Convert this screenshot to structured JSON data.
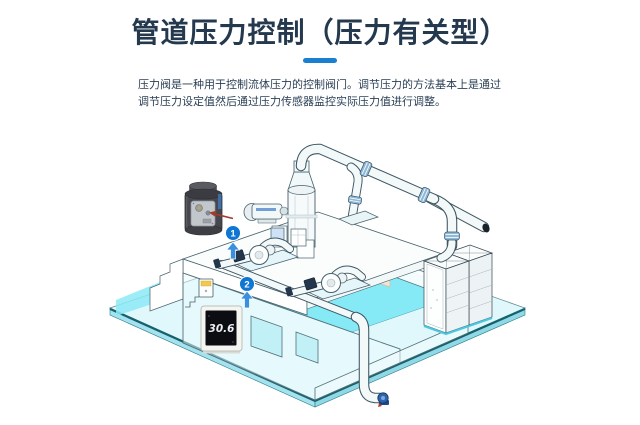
{
  "slide": {
    "title": "管道压力控制（压力有关型）",
    "description_line1": "压力阀是一种用于控制流体压力的控制阀门。调节压力的方法基本上是通过",
    "description_line2": "调节压力设定值然后通过压力传感器监控实际压力值进行调整。"
  },
  "diagram": {
    "step_markers": [
      {
        "label": "1"
      },
      {
        "label": "2"
      }
    ],
    "pressure_display_value": "30.6",
    "icons": {
      "step_arrow": "up-arrow",
      "valve_callout": "red-arrow"
    },
    "colors": {
      "title_text": "#24384e",
      "accent_bar": "#1a7fd1",
      "marker_blue": "#0f77d3",
      "arrow_blue": "#3a90de",
      "water_cyan": "#7de9f6",
      "floor_edge_teal": "#17606b",
      "callout_red": "#a23b2c",
      "valve_body_gray": "#47484e",
      "display_screen": "#0c0d12"
    }
  }
}
